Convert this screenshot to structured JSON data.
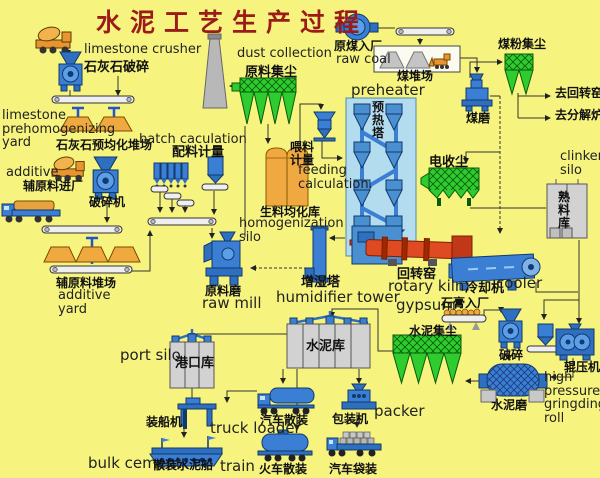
{
  "title": "水泥工艺生产过程",
  "colors": {
    "background": "#F6F47E",
    "title_red": "#9B1B1B",
    "equipment_blue": "#3B7FD4",
    "collector_green": "#2ECC2E",
    "pile_orange": "#F0A93F",
    "kiln_red": "#E04A22",
    "silo_gray": "#D2D2D2",
    "homog_orange": "#F0A840",
    "tower_blue": "#B4DCEF"
  },
  "labels": {
    "limestone_crusher_en": "limestone crusher",
    "limestone_crusher_zh": "石灰石破碎",
    "limestone_yard_en": "limestone prehomogenizing yard",
    "limestone_yard_zh": "石灰石预均化堆场",
    "batch_calculation_en": "batch caculation",
    "batch_calculation_zh": "配料计量",
    "additive_en": "additive",
    "additive_entry_zh": "辅原料进厂",
    "additive_crusher_zh": "破碎机",
    "additive_yard_zh": "辅原料堆场",
    "additive_yard_en": "additive yard",
    "dust_collection_en": "dust collection",
    "dust_collection_zh": "原料集尘",
    "raw_coal_zh": "原煤入厂",
    "raw_coal_en": "raw coal",
    "coal_yard_zh": "煤堆场",
    "coal_mill_zh": "煤磨",
    "coal_dust_zh": "煤粉集尘",
    "to_rotary_kiln_zh": "去回转窑",
    "to_calciner_zh": "去分解炉",
    "preheater_en": "preheater",
    "preheater_zh": "预热塔",
    "feeding_zh": "喂料计量",
    "feeding_en": "feeding calculation.",
    "homogenization_zh": "生料均化库",
    "homogenization_en": "homogenization silo",
    "ep_zh": "电收尘",
    "clinker_silo_en": "clinker silo",
    "clinker_silo_zh": "熟料库",
    "raw_mill_zh": "原料磨",
    "raw_mill_en": "raw mill",
    "humidifier_zh": "增湿塔",
    "humidifier_en": "humidifier tower",
    "rotary_kiln_zh": "回转窑",
    "rotary_kiln_en": "rotary kiln",
    "cooler_zh": "冷却机",
    "cooler_en": "cooler",
    "gypsum_en": "gypsum",
    "gypsum_zh": "石膏入厂",
    "cement_dust_zh": "水泥集尘",
    "gypsum_crusher_zh": "破碎",
    "roller_press_zh": "辊压机",
    "roller_press_en": "high pressure gringding roll",
    "cement_mill_zh": "水泥磨",
    "cement_silo_zh": "水泥库",
    "port_silo_en": "port silo",
    "port_silo_zh": "港口库",
    "ship_loader_zh": "装船机",
    "truck_loader_en": "truck loader",
    "bulk_cement_en": "bulk cement",
    "bulk_ship_zh": "散装水泥船",
    "train_en": "train",
    "train_bulk_zh": "火车散装",
    "truck_bulk_zh": "汽车散装",
    "packer_zh": "包装机",
    "packer_en": "packer",
    "truck_bag_zh": "汽车袋装"
  }
}
